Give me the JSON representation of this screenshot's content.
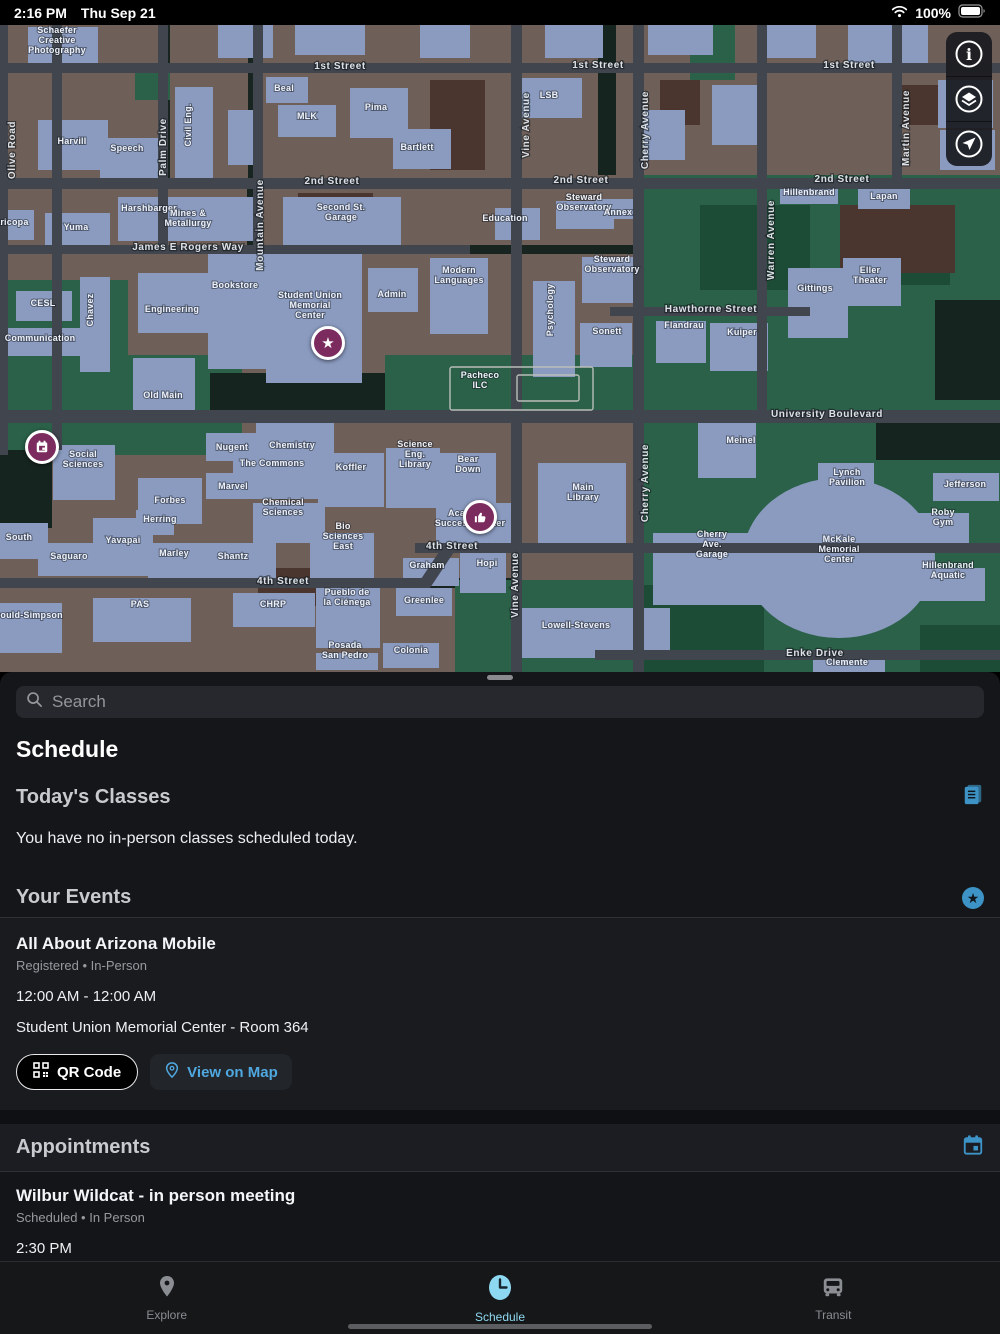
{
  "status_bar": {
    "time": "2:16 PM",
    "date": "Thu Sep 21",
    "battery_pct": "100%"
  },
  "colors": {
    "accent_blue": "#3d93c6",
    "tab_active": "#8ed9f2",
    "marker_purple": "#7c2b5e",
    "link_blue": "#4fa8e0"
  },
  "map": {
    "street_labels": [
      {
        "t": "1st Street",
        "x": 340,
        "y": 44
      },
      {
        "t": "1st Street",
        "x": 598,
        "y": 43
      },
      {
        "t": "1st Street",
        "x": 849,
        "y": 43
      },
      {
        "t": "2nd Street",
        "x": 332,
        "y": 159
      },
      {
        "t": "2nd Street",
        "x": 581,
        "y": 158
      },
      {
        "t": "2nd Street",
        "x": 842,
        "y": 157
      },
      {
        "t": "James E Rogers Way",
        "x": 188,
        "y": 225
      },
      {
        "t": "Hawthorne Street",
        "x": 711,
        "y": 287
      },
      {
        "t": "University Boulevard",
        "x": 827,
        "y": 392,
        "s": 11
      },
      {
        "t": "4th Street",
        "x": 283,
        "y": 559
      },
      {
        "t": "4th Street",
        "x": 452,
        "y": 524
      },
      {
        "t": "Enke Drive",
        "x": 815,
        "y": 631
      },
      {
        "t": "Olive Road",
        "x": 15,
        "y": 125,
        "v": 1
      },
      {
        "t": "Palm Drive",
        "x": 166,
        "y": 122,
        "v": 1
      },
      {
        "t": "Mountain Avenue",
        "x": 263,
        "y": 200,
        "v": 1
      },
      {
        "t": "Vine Avenue",
        "x": 529,
        "y": 100,
        "v": 1
      },
      {
        "t": "Vine Avenue",
        "x": 518,
        "y": 560,
        "v": 1
      },
      {
        "t": "Cherry Avenue",
        "x": 648,
        "y": 105,
        "v": 1
      },
      {
        "t": "Cherry Avenue",
        "x": 648,
        "y": 458,
        "v": 1
      },
      {
        "t": "Warren Avenue",
        "x": 774,
        "y": 215,
        "v": 1
      },
      {
        "t": "Martin Avenue",
        "x": 909,
        "y": 103,
        "v": 1
      }
    ],
    "building_labels": [
      {
        "t": "Schaefer\nCreative\nPhotography",
        "x": 57,
        "y": 18,
        "s": 8
      },
      {
        "t": "Harvill",
        "x": 72,
        "y": 119
      },
      {
        "t": "Speech",
        "x": 127,
        "y": 126
      },
      {
        "t": "Civil Eng.",
        "x": 191,
        "y": 100,
        "v": 1
      },
      {
        "t": "Beal",
        "x": 284,
        "y": 66
      },
      {
        "t": "MLK",
        "x": 307,
        "y": 94
      },
      {
        "t": "Pima",
        "x": 376,
        "y": 85
      },
      {
        "t": "Bartlett",
        "x": 417,
        "y": 125
      },
      {
        "t": "LSB",
        "x": 549,
        "y": 73
      },
      {
        "t": "Hillenbrand",
        "x": 809,
        "y": 170
      },
      {
        "t": "Lapan",
        "x": 884,
        "y": 174
      },
      {
        "t": "Yuma",
        "x": 76,
        "y": 205
      },
      {
        "t": "Maricopa",
        "x": 8,
        "y": 200
      },
      {
        "t": "Harshbarger",
        "x": 149,
        "y": 186
      },
      {
        "t": "Mines &\nMetallurgy",
        "x": 188,
        "y": 196
      },
      {
        "t": "Second St.\nGarage",
        "x": 341,
        "y": 190,
        "s": 11
      },
      {
        "t": "CESL",
        "x": 43,
        "y": 281
      },
      {
        "t": "Chavez",
        "x": 93,
        "y": 285,
        "v": 1
      },
      {
        "t": "Communication",
        "x": 40,
        "y": 316
      },
      {
        "t": "Engineering",
        "x": 172,
        "y": 287
      },
      {
        "t": "Bookstore",
        "x": 235,
        "y": 263
      },
      {
        "t": "Student Union\nMemorial\nCenter",
        "x": 310,
        "y": 283
      },
      {
        "t": "Admin",
        "x": 392,
        "y": 272
      },
      {
        "t": "Modern\nLanguages",
        "x": 459,
        "y": 253
      },
      {
        "t": "Old Main",
        "x": 163,
        "y": 373
      },
      {
        "t": "Pacheco\nILC",
        "x": 480,
        "y": 358
      },
      {
        "t": "Education",
        "x": 505,
        "y": 196
      },
      {
        "t": "Steward\nObservatory",
        "x": 584,
        "y": 180
      },
      {
        "t": "Annex",
        "x": 618,
        "y": 190
      },
      {
        "t": "Steward\nObservatory",
        "x": 612,
        "y": 242
      },
      {
        "t": "Psychology",
        "x": 553,
        "y": 285,
        "v": 1
      },
      {
        "t": "Sonett",
        "x": 607,
        "y": 309
      },
      {
        "t": "Flandrau",
        "x": 684,
        "y": 303
      },
      {
        "t": "Kuiper",
        "x": 742,
        "y": 310
      },
      {
        "t": "Gittings",
        "x": 815,
        "y": 266
      },
      {
        "t": "Eller\nTheater",
        "x": 870,
        "y": 253
      },
      {
        "t": "Jefferson",
        "x": 965,
        "y": 462
      },
      {
        "t": "Social\nSciences",
        "x": 83,
        "y": 437
      },
      {
        "t": "South",
        "x": 19,
        "y": 515
      },
      {
        "t": "Saguaro",
        "x": 69,
        "y": 534,
        "s": 8
      },
      {
        "t": "Yavapai",
        "x": 123,
        "y": 518
      },
      {
        "t": "Forbes",
        "x": 170,
        "y": 478
      },
      {
        "t": "Herring",
        "x": 160,
        "y": 497
      },
      {
        "t": "Marley",
        "x": 174,
        "y": 531
      },
      {
        "t": "Nugent",
        "x": 232,
        "y": 425
      },
      {
        "t": "The Commons",
        "x": 272,
        "y": 441
      },
      {
        "t": "Marvel",
        "x": 233,
        "y": 464
      },
      {
        "t": "Chemistry",
        "x": 292,
        "y": 423
      },
      {
        "t": "Chemical\nSciences",
        "x": 283,
        "y": 485
      },
      {
        "t": "Koffler",
        "x": 351,
        "y": 445
      },
      {
        "t": "Science\nEng.\nLibrary",
        "x": 415,
        "y": 432
      },
      {
        "t": "Bear\nDown",
        "x": 468,
        "y": 442
      },
      {
        "t": "Shantz",
        "x": 233,
        "y": 534
      },
      {
        "t": "Bio\nSciences\nEast",
        "x": 343,
        "y": 514
      },
      {
        "t": "Academic\nSuccess Center",
        "x": 470,
        "y": 496
      },
      {
        "t": "PAS",
        "x": 140,
        "y": 582
      },
      {
        "t": "Gould-Simpson",
        "x": 28,
        "y": 593
      },
      {
        "t": "CHRP",
        "x": 273,
        "y": 582
      },
      {
        "t": "Pueblo de\nla Ciénega",
        "x": 347,
        "y": 575
      },
      {
        "t": "Graham",
        "x": 427,
        "y": 543
      },
      {
        "t": "Greenlee",
        "x": 424,
        "y": 578
      },
      {
        "t": "Hopi",
        "x": 487,
        "y": 541
      },
      {
        "t": "Posada\nSan Pedro",
        "x": 345,
        "y": 628,
        "s": 8
      },
      {
        "t": "Colonia",
        "x": 411,
        "y": 628
      },
      {
        "t": "Main\nLibrary",
        "x": 583,
        "y": 470
      },
      {
        "t": "Meinel",
        "x": 741,
        "y": 418
      },
      {
        "t": "Cherry\nAve.\nGarage",
        "x": 712,
        "y": 522
      },
      {
        "t": "Lynch\nPavilion",
        "x": 847,
        "y": 455
      },
      {
        "t": "McKale\nMemorial\nCenter",
        "x": 839,
        "y": 527
      },
      {
        "t": "Roby\nGym",
        "x": 943,
        "y": 495
      },
      {
        "t": "Hillenbrand\nAquatic",
        "x": 948,
        "y": 548
      },
      {
        "t": "Lowell-Stevens",
        "x": 576,
        "y": 603
      },
      {
        "t": "Clemente",
        "x": 847,
        "y": 640
      }
    ],
    "markers": [
      {
        "icon": "star",
        "x": 328,
        "y": 318
      },
      {
        "icon": "calendar",
        "x": 42,
        "y": 422
      },
      {
        "icon": "thumbs-up",
        "x": 480,
        "y": 492
      }
    ]
  },
  "sheet": {
    "search_placeholder": "Search",
    "title": "Schedule",
    "todays_classes": {
      "header": "Today's Classes",
      "empty_message": "You have no in-person classes scheduled today."
    },
    "events": {
      "header": "Your Events",
      "items": [
        {
          "title": "All About Arizona Mobile",
          "status": "Registered • In-Person",
          "time": "12:00 AM - 12:00 AM",
          "location": "Student Union Memorial Center - Room 364",
          "qr_label": "QR Code",
          "map_label": "View on Map"
        }
      ]
    },
    "appointments": {
      "header": "Appointments",
      "items": [
        {
          "title": "Wilbur Wildcat - in person meeting",
          "status": "Scheduled • In Person",
          "time": "2:30 PM"
        }
      ]
    }
  },
  "tab_bar": {
    "explore": "Explore",
    "schedule": "Schedule",
    "transit": "Transit"
  }
}
